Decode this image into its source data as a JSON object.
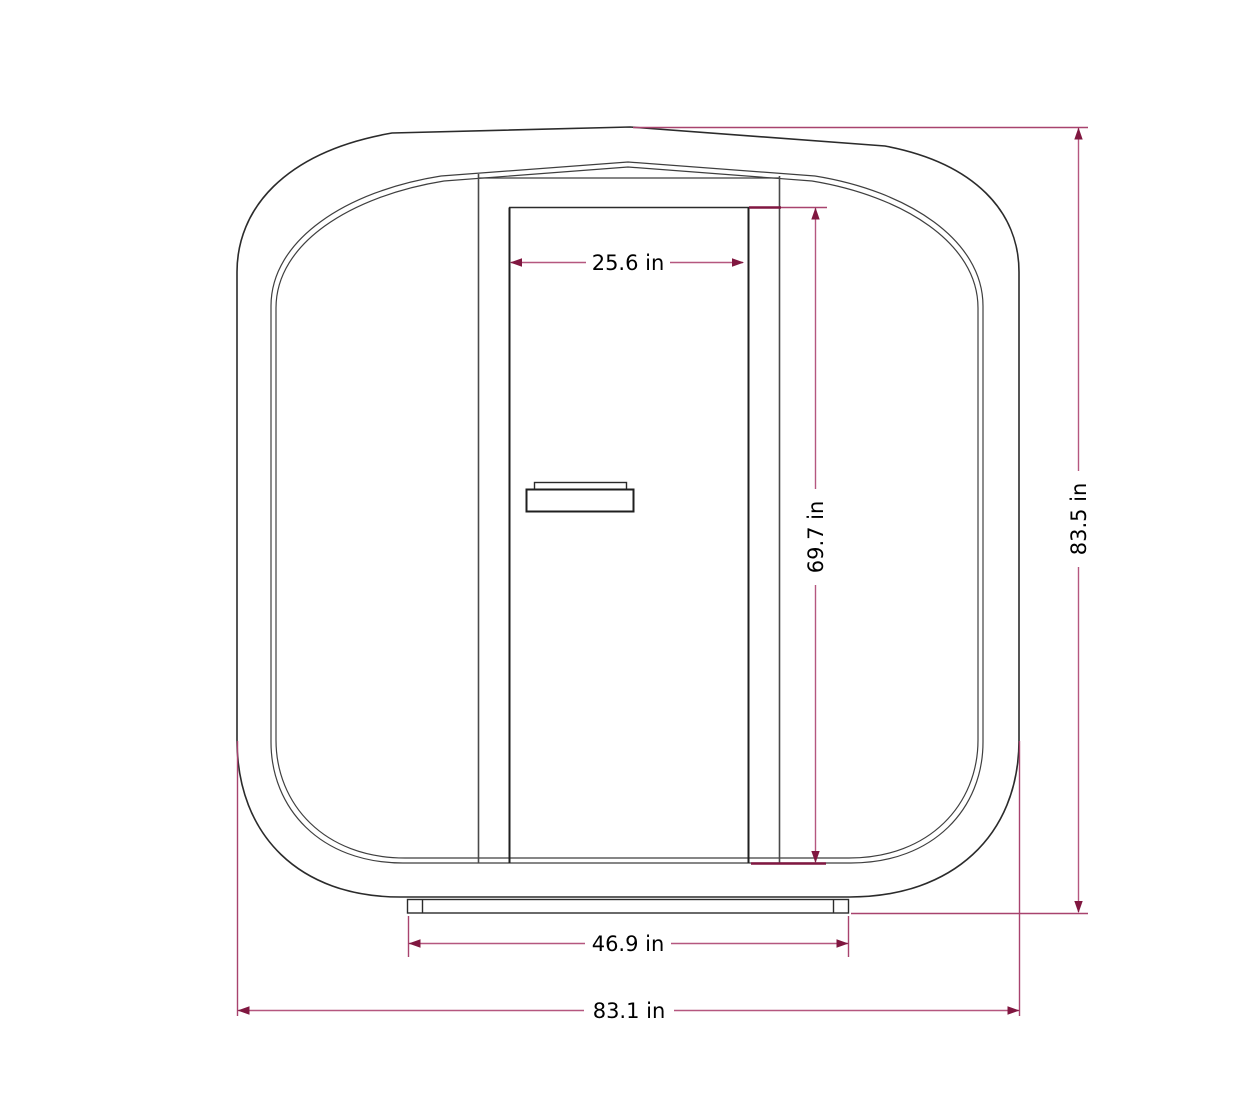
{
  "diagram": {
    "kind": "dimensional-drawing",
    "subject": "office-pod-front-elevation",
    "unit": "in",
    "dimensions": {
      "door_width": {
        "label": "25.6 in",
        "value": 25.6
      },
      "door_height": {
        "label": "69.7 in",
        "value": 69.7
      },
      "overall_height": {
        "label": "83.5 in",
        "value": 83.5
      },
      "base_width": {
        "label": "46.9 in",
        "value": 46.9
      },
      "overall_width": {
        "label": "83.1 in",
        "value": 83.1
      }
    },
    "colors": {
      "background": "#ffffff",
      "outline": "#2b2b2b",
      "inner_wall_line": "#3f3f3f",
      "dimension_line": "#b5577f",
      "dimension_accent": "#801740",
      "label_text": "#000000"
    }
  }
}
